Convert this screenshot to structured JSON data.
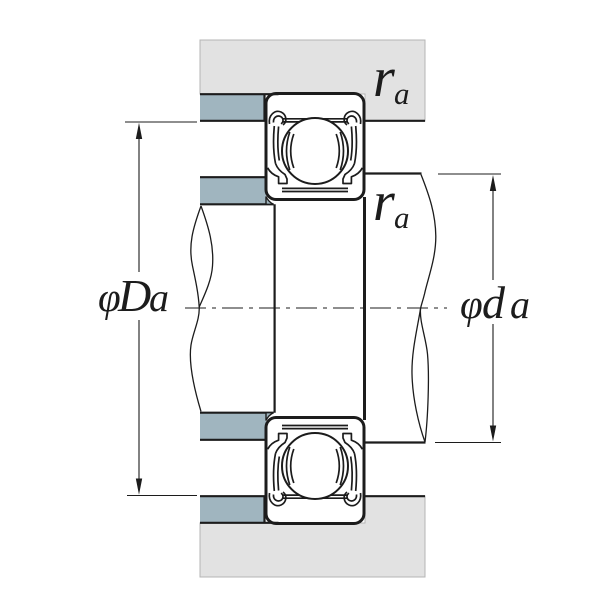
{
  "drawing": {
    "title": "bearing-shoulder-fillet-cross-section",
    "labels": {
      "housing_fillet": {
        "symbol": "r",
        "subscript": "a"
      },
      "shaft_fillet": {
        "symbol": "r",
        "subscript": "a"
      },
      "housing_abutment_diameter": {
        "prefix": "φ",
        "symbol": "D",
        "subscript": "a"
      },
      "shaft_abutment_diameter": {
        "prefix": "φ",
        "symbol": "d",
        "subscript": "a"
      }
    },
    "colors": {
      "housing_fill": "#e2e2e2",
      "shoulder_fill": "#a0b5bf",
      "line": "#1c1c1c",
      "housing_edge": "#b4b4b4"
    }
  }
}
